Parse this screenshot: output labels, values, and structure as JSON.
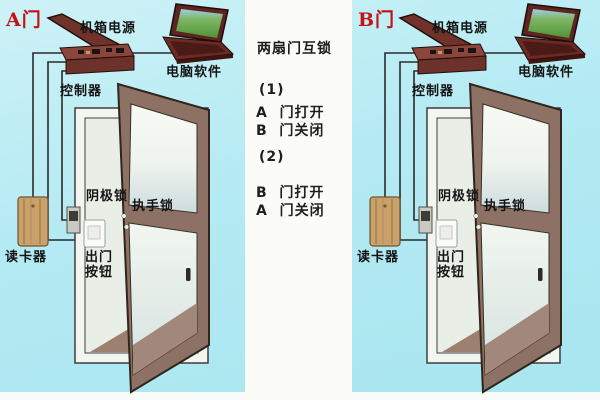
{
  "diagram_title": "两扇门互锁",
  "colors": {
    "background_cyan": "#b4eaf3",
    "panel_white": "#fbfcf7",
    "door_tag_red": "#c41111",
    "door_leaf_brown": "#8c7164",
    "device_maroon": "#7d3c34",
    "card_reader_tan": "#c9a26b",
    "text_black": "#141414"
  },
  "interlock_panel": {
    "title": "两扇门互锁",
    "case1_num": "(1)",
    "case1_line1": "A  门打开",
    "case1_line2": "B  门关闭",
    "case2_num": "(2)",
    "case2_line1": "B  门打开",
    "case2_line2": "A  门关闭"
  },
  "unit_a": {
    "door_tag": "A门",
    "labels": {
      "power_box": "机箱电源",
      "computer_software": "电脑软件",
      "controller": "控制器",
      "cathode_lock": "阴极锁",
      "handle_lock": "执手锁",
      "exit_button_line1": "出门",
      "exit_button_line2": "按钮",
      "card_reader": "读卡器"
    }
  },
  "unit_b": {
    "door_tag": "B门",
    "labels": {
      "power_box": "机箱电源",
      "computer_software": "电脑软件",
      "controller": "控制器",
      "cathode_lock": "阴极锁",
      "handle_lock": "执手锁",
      "exit_button_line1": "出门",
      "exit_button_line2": "按钮",
      "card_reader": "读卡器"
    }
  }
}
